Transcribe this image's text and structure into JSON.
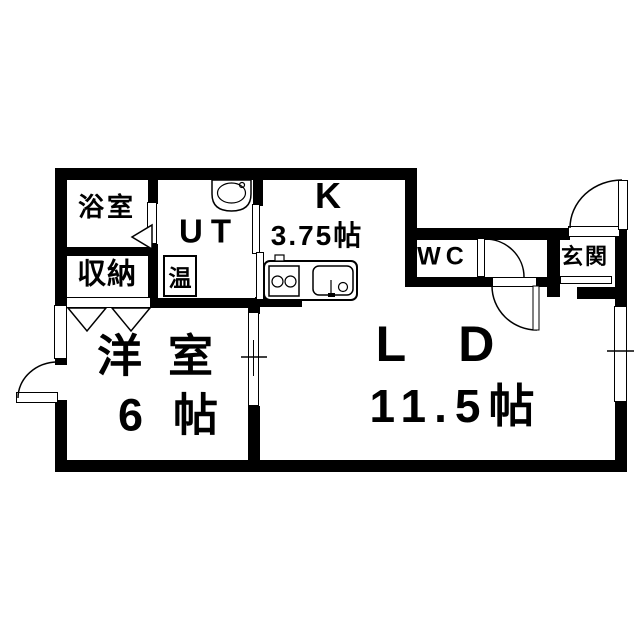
{
  "plan": {
    "rooms": {
      "bathroom": {
        "label": "浴室"
      },
      "storage": {
        "label": "収納"
      },
      "utility": {
        "label": "UT"
      },
      "kitchen": {
        "label": "K",
        "size": "3.75帖"
      },
      "toilet": {
        "label": "WC"
      },
      "entrance": {
        "label": "玄関"
      },
      "western_room": {
        "label": "洋室",
        "size": "6帖"
      },
      "living_dining": {
        "label": "LD",
        "size": "11.5帖"
      }
    },
    "fixtures": {
      "water_heater": {
        "label": "温"
      },
      "washbasin": "washbasin",
      "stove": "two-burner-stove",
      "sink": "kitchen-sink"
    },
    "colors": {
      "wall": "#000000",
      "floor": "#ffffff",
      "line": "#000000"
    }
  }
}
